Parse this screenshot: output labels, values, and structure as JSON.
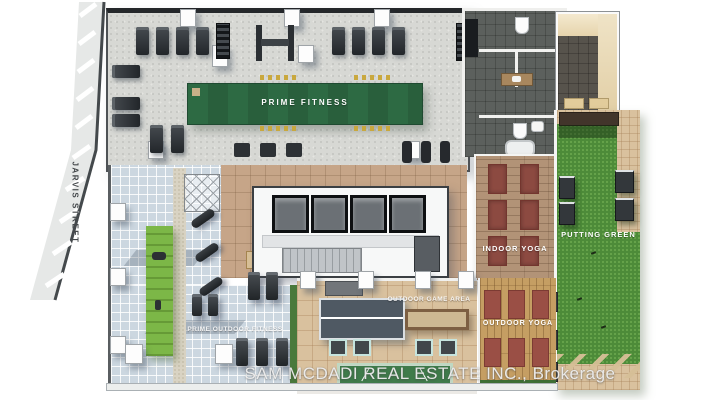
{
  "street": {
    "label": "JARVIS STREET"
  },
  "areas": {
    "prime_fitness": {
      "label": "PRIME FITNESS"
    },
    "indoor_yoga": {
      "label": "INDOOR YOGA"
    },
    "putting_green": {
      "label": "PUTTING GREEN"
    },
    "outdoor_game_area": {
      "label": "OUTDOOR GAME AREA"
    },
    "outdoor_yoga": {
      "label": "OUTDOOR YOGA"
    },
    "prime_outdoor_fitness": {
      "label": "PRIME OUTDOOR FITNESS"
    }
  },
  "watermark": "SAM MCDADI REAL ESTATE INC., Brokerage",
  "colors": {
    "fitness_turf": "#2d6a43",
    "putting_green": "#4d8b39",
    "outdoor_turf": "#7cb747",
    "yoga_wood": "#b29377",
    "deck_wood": "#c59e63",
    "terrace_tile": "#ccd7e0",
    "paver_tan": "#d9c19e",
    "gym_floor": "#d7d8d4",
    "washroom_tile": "#5c605d",
    "yoga_mat": "#8c4a41",
    "street_gray": "#e6e8e7"
  }
}
